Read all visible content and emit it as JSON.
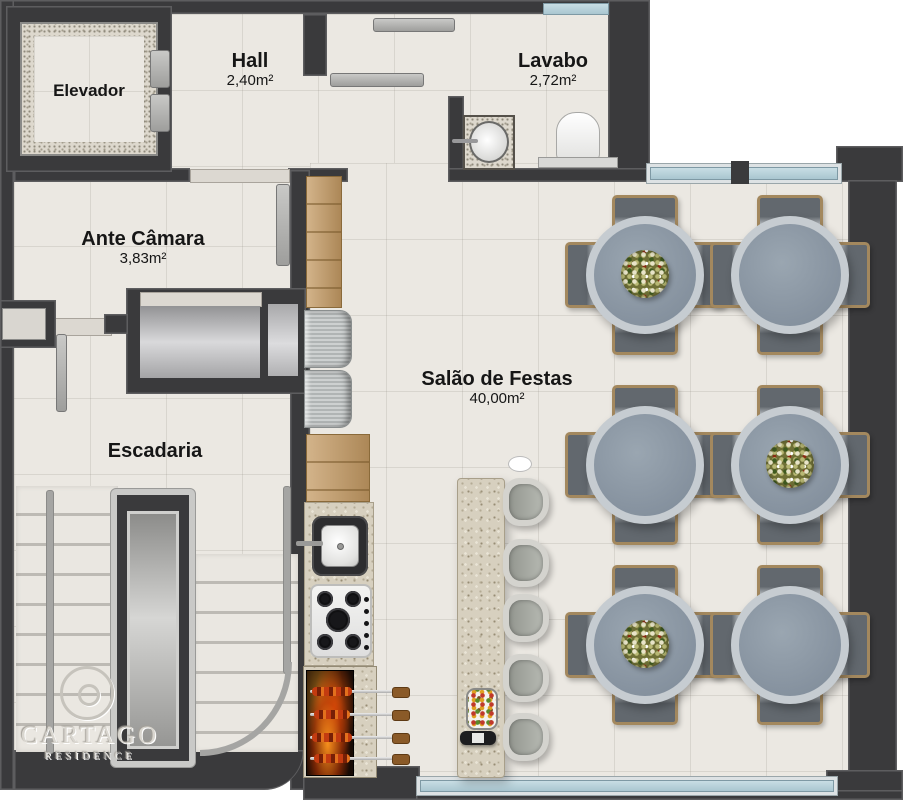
{
  "branding": {
    "emblem_letter": "C",
    "name": "CARTAGO",
    "subtitle": "RESIDENCE"
  },
  "rooms": {
    "elevador": {
      "name": "Elevador"
    },
    "hall": {
      "name": "Hall",
      "area": "2,40m²"
    },
    "lavabo": {
      "name": "Lavabo",
      "area": "2,72m²"
    },
    "ante_camara": {
      "name": "Ante Câmara",
      "area": "3,83m²"
    },
    "escadaria": {
      "name": "Escadaria"
    },
    "salao_de_festas": {
      "name": "Salão de Festas",
      "area": "40,00m²"
    }
  },
  "furniture": {
    "dining_tables": 6,
    "chairs_per_table": 4,
    "bar_stools": 5,
    "grill_skewers": 4,
    "stove_burners": 5,
    "tables_with_platters": 3
  },
  "colors": {
    "wall": "#3a3a3c",
    "floor": "#ebe8e2",
    "window_glass": "#b9d4dc",
    "table_top": "#8c98a4",
    "chair_wood": "#a3885e",
    "counter_granite": "#d7d0bf",
    "cabinet_wood": "#c49a63",
    "fire": "#ff7a1e"
  }
}
